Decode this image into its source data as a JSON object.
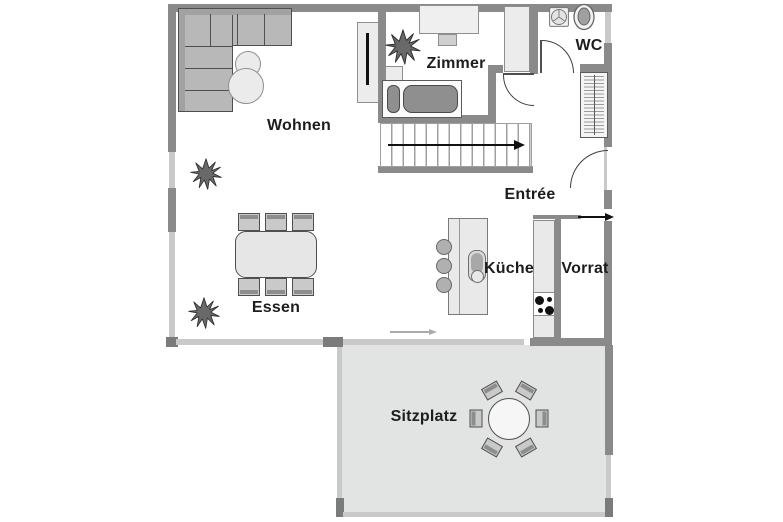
{
  "title": "Floor plan ground floor",
  "rooms": {
    "wohnen": {
      "label": "Wohnen"
    },
    "zimmer": {
      "label": "Zimmer"
    },
    "wc": {
      "label": "WC"
    },
    "entree": {
      "label": "Entrée"
    },
    "kueche": {
      "label": "Küche"
    },
    "vorrat": {
      "label": "Vorrat"
    },
    "essen": {
      "label": "Essen"
    },
    "sitzplatz": {
      "label": "Sitzplatz"
    }
  },
  "colors": {
    "wall_dark": "#8a8a8a",
    "wall_block": "#7b7b7b",
    "wall_light": "#c9c9c9",
    "furniture_fill": "#ececec",
    "sofa_fill": "#b8b8b8",
    "dark_upholstery": "#8f8f8f",
    "terrace_fill": "#e2e3e3",
    "text": "#1d1d1d",
    "arrow_dark": "#111111",
    "arrow_light": "#ababab"
  },
  "icons": {
    "plant": "starburst",
    "washbasin": "circle-in-square-with-spokes",
    "toilet": "double-oval",
    "stove": "four-burner-dots",
    "stair_direction": "arrow-right",
    "entry_direction": "arrow-right",
    "walk_path": "arrow-right"
  },
  "furniture": [
    "corner-sofa",
    "side-tables",
    "tv-sideboard",
    "plants",
    "desk",
    "desk-chair",
    "bed",
    "nightstand",
    "wardrobe",
    "washbasin",
    "toilet",
    "built-in-closet",
    "stairs",
    "kitchen-island",
    "island-sink",
    "bar-stools",
    "kitchen-counter",
    "stove",
    "dining-table",
    "dining-chairs",
    "terrace-round-table",
    "terrace-chairs"
  ]
}
